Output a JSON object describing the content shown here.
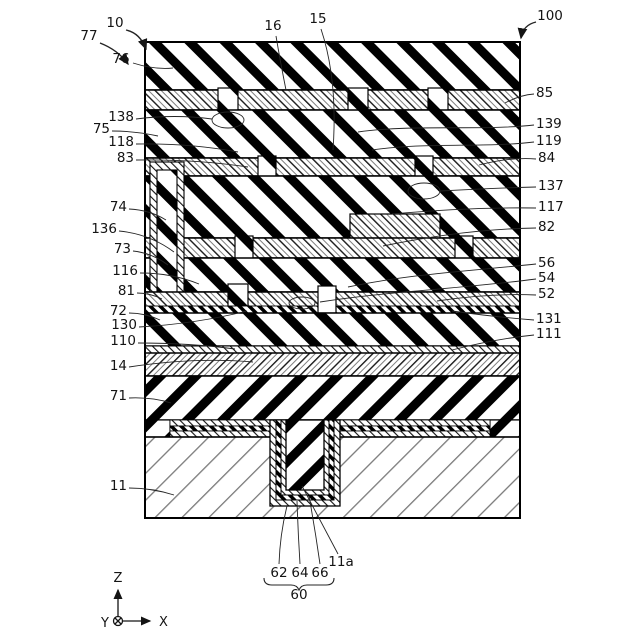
{
  "figure": {
    "kind": "patent-cross-section-diagram",
    "colors": {
      "ink": "#000000",
      "background": "#ffffff",
      "thin_hatch_gray": "#808080"
    },
    "axis_triad": {
      "z": "Z",
      "x": "X",
      "y": "Y"
    },
    "brace_group": {
      "label": "60",
      "members": [
        "62",
        "64",
        "66"
      ]
    },
    "labels": [
      {
        "text": "10",
        "x": 115,
        "y": 27,
        "anchor": "middle",
        "leader": "M126,30 Q140,33 146,49",
        "arrow": true
      },
      {
        "text": "77",
        "x": 89,
        "y": 40,
        "anchor": "middle",
        "leader": "M100,43 Q118,50 128,64",
        "arrow": true
      },
      {
        "text": "100",
        "x": 550,
        "y": 20,
        "anchor": "middle",
        "leader": "M536,22 Q523,25 521,38",
        "arrow": true
      },
      {
        "text": "76",
        "x": 121,
        "y": 63,
        "anchor": "middle",
        "leader": "M133,63 Q155,70 173,68"
      },
      {
        "text": "16",
        "x": 273,
        "y": 30,
        "anchor": "middle",
        "leader": "M276,36 Q280,60 286,90"
      },
      {
        "text": "15",
        "x": 318,
        "y": 23,
        "anchor": "middle",
        "leader": "M321,29 Q338,80 333,150"
      },
      {
        "text": "138",
        "x": 134,
        "y": 121,
        "anchor": "end",
        "leader": "M136,119 Q175,114 212,119"
      },
      {
        "text": "75",
        "x": 110,
        "y": 133,
        "anchor": "end",
        "leader": "M112,131 Q135,131 158,136"
      },
      {
        "text": "118",
        "x": 134,
        "y": 146,
        "anchor": "end",
        "leader": "M136,144 Q190,143 238,152"
      },
      {
        "text": "83",
        "x": 134,
        "y": 162,
        "anchor": "end",
        "leader": "M136,160 Q195,159 248,167"
      },
      {
        "text": "74",
        "x": 127,
        "y": 211,
        "anchor": "end",
        "leader": "M129,209 Q150,210 166,220"
      },
      {
        "text": "136",
        "x": 117,
        "y": 233,
        "anchor": "end",
        "leader": "M119,231 Q150,234 174,252"
      },
      {
        "text": "73",
        "x": 131,
        "y": 253,
        "anchor": "end",
        "leader": "M133,251 Q152,253 168,265"
      },
      {
        "text": "116",
        "x": 138,
        "y": 275,
        "anchor": "end",
        "leader": "M140,273 Q172,273 199,284"
      },
      {
        "text": "81",
        "x": 135,
        "y": 295,
        "anchor": "end",
        "leader": "M137,293 Q150,293 162,299"
      },
      {
        "text": "72",
        "x": 127,
        "y": 315,
        "anchor": "end",
        "leader": "M129,313 Q145,313 160,320"
      },
      {
        "text": "130",
        "x": 137,
        "y": 329,
        "anchor": "end",
        "leader": "M139,327 Q195,324 247,311"
      },
      {
        "text": "110",
        "x": 136,
        "y": 345,
        "anchor": "end",
        "leader": "M138,343 Q190,343 235,349"
      },
      {
        "text": "14",
        "x": 127,
        "y": 370,
        "anchor": "end",
        "leader": "M129,367 Q195,357 253,362"
      },
      {
        "text": "71",
        "x": 127,
        "y": 400,
        "anchor": "end",
        "leader": "M129,398 Q152,397 171,403"
      },
      {
        "text": "11",
        "x": 127,
        "y": 490,
        "anchor": "end",
        "leader": "M129,488 Q152,488 174,495"
      },
      {
        "text": "85",
        "x": 536,
        "y": 97,
        "anchor": "start",
        "leader": "M534,94 Q520,95 505,103"
      },
      {
        "text": "139",
        "x": 536,
        "y": 128,
        "anchor": "start",
        "leader": "M534,125 C480,131 415,124 358,132"
      },
      {
        "text": "119",
        "x": 536,
        "y": 145,
        "anchor": "start",
        "leader": "M534,142 C485,148 425,142 372,150"
      },
      {
        "text": "84",
        "x": 538,
        "y": 162,
        "anchor": "start",
        "leader": "M536,159 Q510,157 479,165"
      },
      {
        "text": "137",
        "x": 538,
        "y": 190,
        "anchor": "start",
        "leader": "M536,187 Q495,188 440,191"
      },
      {
        "text": "117",
        "x": 538,
        "y": 211,
        "anchor": "start",
        "leader": "M536,208 Q470,207 392,214"
      },
      {
        "text": "82",
        "x": 538,
        "y": 231,
        "anchor": "start",
        "leader": "M536,228 Q465,229 383,246"
      },
      {
        "text": "56",
        "x": 538,
        "y": 267,
        "anchor": "start",
        "leader": "M536,264 C470,271 410,274 348,287"
      },
      {
        "text": "54",
        "x": 538,
        "y": 282,
        "anchor": "start",
        "leader": "M536,279 C460,289 390,291 320,302"
      },
      {
        "text": "52",
        "x": 538,
        "y": 298,
        "anchor": "start",
        "leader": "M536,295 Q490,293 437,301"
      },
      {
        "text": "131",
        "x": 536,
        "y": 323,
        "anchor": "start",
        "leader": "M534,320 Q495,317 452,311"
      },
      {
        "text": "111",
        "x": 536,
        "y": 338,
        "anchor": "start",
        "leader": "M534,335 Q495,339 452,350"
      },
      {
        "text": "11a",
        "x": 341,
        "y": 566,
        "anchor": "middle",
        "leader": "M338,554 Q320,520 302,486"
      },
      {
        "text": "62",
        "x": 279,
        "y": 577,
        "anchor": "middle",
        "leader": "M279,564 Q280,534 287,506"
      },
      {
        "text": "64",
        "x": 300,
        "y": 577,
        "anchor": "middle",
        "leader": "M300,564 Q298,532 297,501"
      },
      {
        "text": "66",
        "x": 320,
        "y": 577,
        "anchor": "middle",
        "leader": "M320,564 Q315,529 309,496"
      },
      {
        "text": "60",
        "x": 299,
        "y": 599,
        "anchor": "middle"
      }
    ],
    "emphasis_ellipses": [
      {
        "cx": 228,
        "cy": 120,
        "rx": 16,
        "ry": 8
      },
      {
        "cx": 424,
        "cy": 191,
        "rx": 16,
        "ry": 8
      },
      {
        "cx": 302,
        "cy": 303,
        "rx": 13,
        "ry": 6
      }
    ]
  }
}
